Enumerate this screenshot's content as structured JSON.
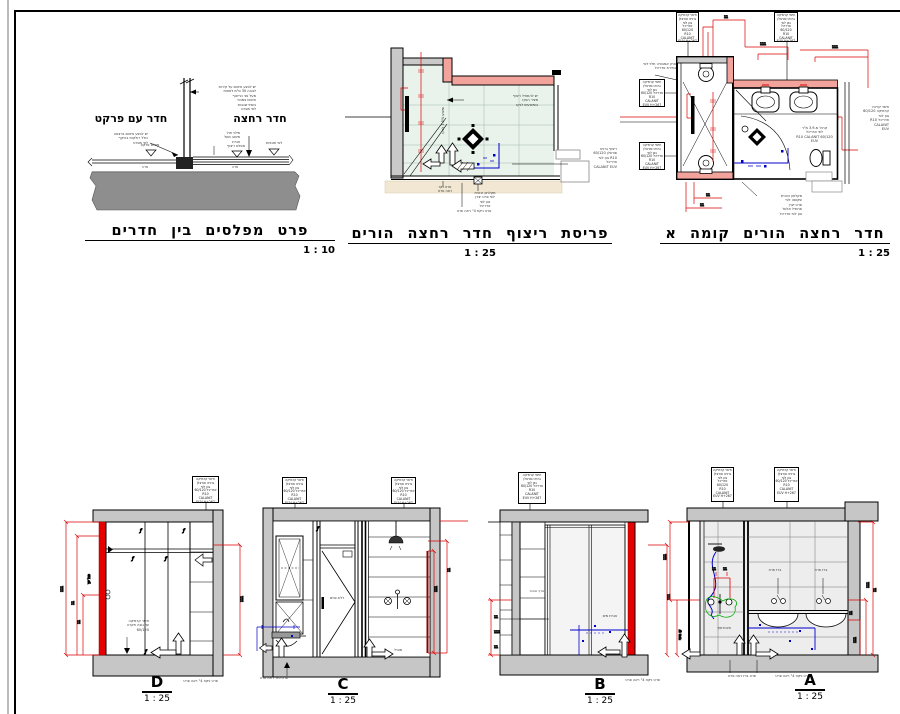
{
  "titles": {
    "detail": {
      "text": "פרט מפלסים בין חדרים",
      "scale": "1 : 10"
    },
    "tiling": {
      "text": "פריסת ריצוף חדר רחצה הורים",
      "scale": "1 : 25"
    },
    "plan": {
      "text": "חדר רחצה הורים קומה א",
      "scale": "1 : 25"
    }
  },
  "rooms": {
    "left": "חדר עם פרקט",
    "right": "חדר רחצה"
  },
  "elevations": {
    "d": {
      "letter": "D",
      "scale": "1 : 25"
    },
    "c": {
      "letter": "C",
      "scale": "1 : 25"
    },
    "b": {
      "letter": "B",
      "scale": "1 : 25"
    },
    "a": {
      "letter": "A",
      "scale": "1 : 25"
    }
  },
  "dims": {
    "two": "11",
    "three": "111"
  },
  "symbols": {
    "finish_tag": "ƒ"
  },
  "micro": {
    "spec_box": "חיפוי קרמיקה\nגרניט פורצלן\nגוון לפי\nאדריכל 60/120\nR10\nCALANIT\nEUV H+267",
    "m_d1": "יש לבצע איטום על קירות\nלגובה 30 ס\"מ לפחות\nמעל פני הריצוף\nאיטום צמנטי\nבשתי שכבות\nלפי מפרט",
    "m_d2": "יש לבצע איטום ברצפה\nכולל רולקות בהיקף\nלפי מפרט",
    "m_d3": "מילוי חול\nמיוצב מעל\nצנרת",
    "m_d4": "מפלס פרקט",
    "m_d5": "מפלס ריצוף",
    "m_d6": "לפי תוכניות",
    "m_d7": "מדה",
    "m_d8": "מדה",
    "m_t1": "יש להתחיל ריצוף\nמציר הנקז\nבשיפועים לנקז",
    "m_t2": "שיפוע 1.5% לנקז",
    "m_t3": "ריצוף גרניט\nפורצלן 60/120\nR10 גוון לפי\nאדריכל\nCALANIT EUV",
    "m_t4": "פרט נקז\nראה פרט",
    "m_t5": "מקלחון זכוכית\nלפי פרט יצרן\nגוון לפי\nאדריכל",
    "m_t6": "פרט ניקוז 4\" ראה פרט",
    "m_p5": "ארון אמבטיה תלוי לפי\nבחירת אדריכל",
    "m_p6": "קרמ' מ-3.9 מ\"ר\nלפי אדריכל\n60/120 R10 CALANIT\nEUV",
    "m_p7": "חיפוי קירות\nקרמיקה 60/120\nגוון לפי\nאדריכל R10\nCALANIT\nEUV",
    "m_p8": "מקלחון זכוכית\nשקופה לפי\nפרט יצרן\nפרופיל אלומ'\nגוון לפי אדריכל",
    "m_ed1": "חיפוי קרמיקה\nעד גובה תקרה\n60/120",
    "m_ed2": "פרט ניקוז 4\" ראה פרט",
    "m_ec1": "דלת פנים",
    "m_ec2": "פרט כיור ראה פרט",
    "m_ec3": "מוביל",
    "m_eb1": "מדף זכוכית",
    "m_eb2": "צנרת מים",
    "m_eb3": "פרט ניקוז 4\" ראה פרט",
    "m_ea1": "אינטרפוץ",
    "m_ea2": "ברז פרח",
    "m_ea3": "ברז פרח",
    "m_ea4": "פרט ברז ראה פרט",
    "m_ea5": "פרט ניקוז 4\" ראה פרט",
    "m_rot1": "פנל עץ",
    "m_rot2": "קו חיפוי"
  }
}
